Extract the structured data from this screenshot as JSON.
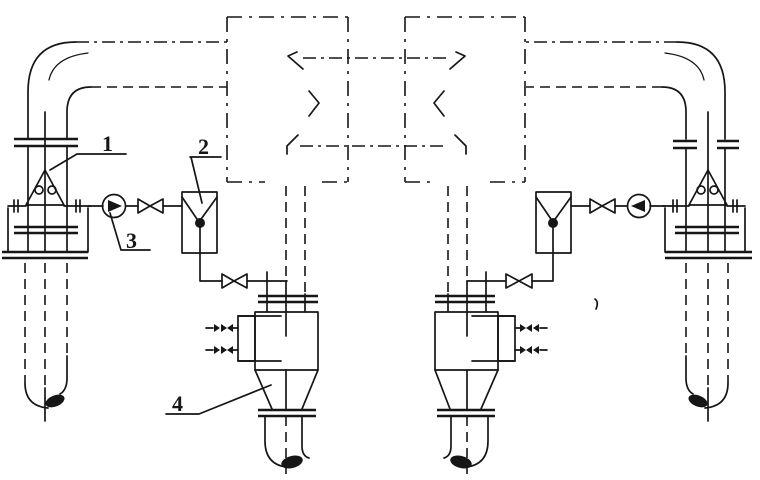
{
  "canvas": {
    "background": "#ffffff",
    "ink": "#161616"
  },
  "callouts": {
    "label_1": "1",
    "label_2": "2",
    "label_3": "3",
    "label_4": "4"
  }
}
